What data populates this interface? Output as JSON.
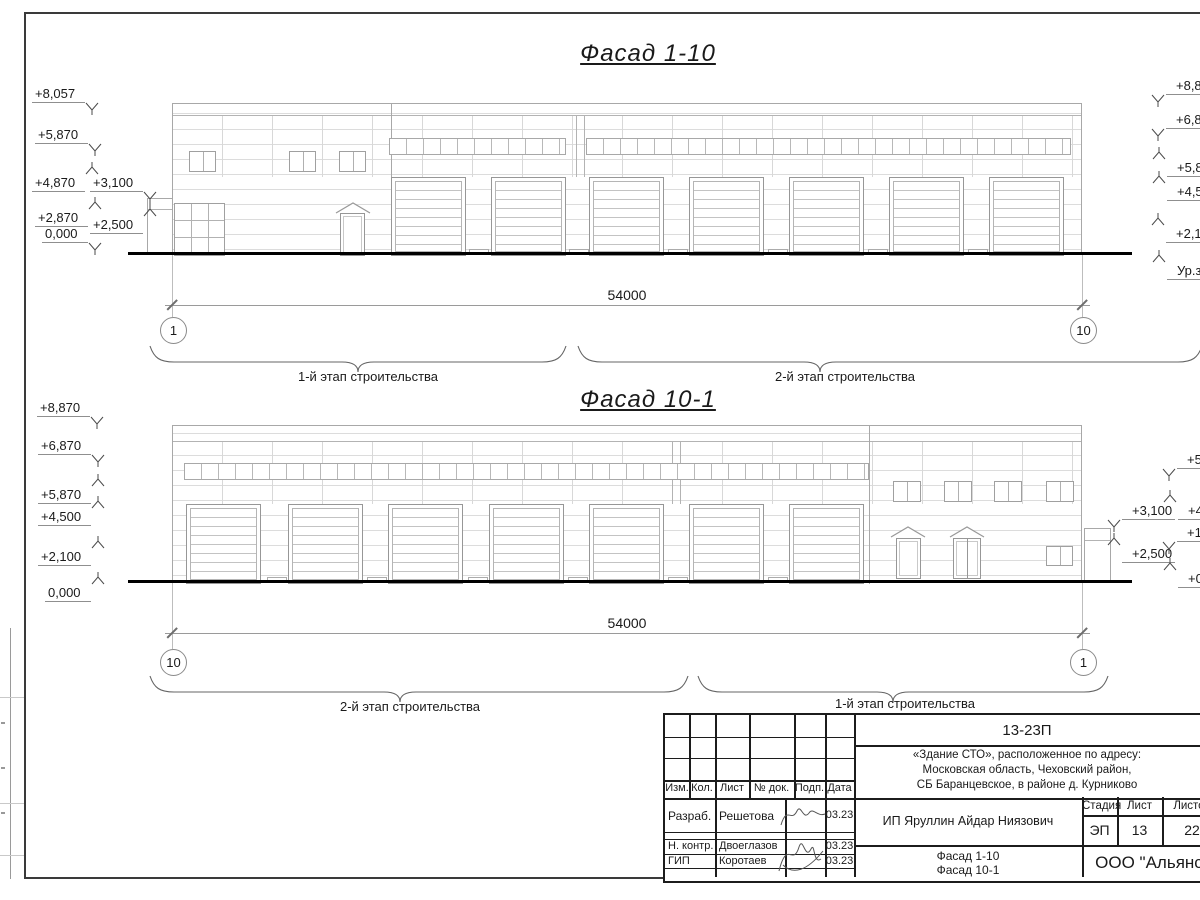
{
  "facade1": {
    "title": "Фасад 1-10",
    "dimension": "54000",
    "axis_left": "1",
    "axis_right": "10",
    "stage_label_left": "1-й этап строительства",
    "stage_label_right": "2-й этап строительства",
    "left_marks": [
      "+8,057",
      "+5,870",
      "+4,870",
      "+3,100",
      "+2,870",
      "+2,500",
      "0,000"
    ],
    "right_marks": [
      "+8,870",
      "+6,870",
      "+5,87",
      "+4,50",
      "+2,10",
      "Ур.зе"
    ]
  },
  "facade2": {
    "title": "Фасад 10-1",
    "dimension": "54000",
    "axis_left": "10",
    "axis_right": "1",
    "stage_label_left": "2-й этап строительства",
    "stage_label_right": "1-й этап строительства",
    "left_marks": [
      "+8,870",
      "+6,870",
      "+5,870",
      "+4,500",
      "+2,100",
      "0,000"
    ],
    "right_marks_inner": [
      "+3,100",
      "+2,500"
    ],
    "right_marks_edge": [
      "+5,8",
      "+4,8",
      "+1,8",
      "+0,8"
    ]
  },
  "title_block": {
    "doc_number": "13-23П",
    "address_lines": [
      "«Здание СТО», расположенное по адресу:",
      "Московская область, Чеховский район,",
      "СБ Баранцевское, в районе д. Курниково"
    ],
    "col_headers": [
      "Изм.",
      "Кол.",
      "Лист",
      "№ док.",
      "Подп.",
      "Дата"
    ],
    "sign_rows": [
      {
        "role": "Разраб.",
        "name": "Решетова",
        "date": "03.23"
      },
      {
        "role": "Н. контр.",
        "name": "Двоеглазов",
        "date": "03.23"
      },
      {
        "role": "ГИП",
        "name": "Коротаев",
        "date": "03.23"
      }
    ],
    "client": "ИП Яруллин Айдар Ниязович",
    "stage_header": "Стадия",
    "sheet_header": "Лист",
    "sheets_header": "Листов",
    "stage": "ЭП",
    "sheet_no": "13",
    "sheets_total": "22",
    "drawing_name_lines": [
      "Фасад 1-10",
      "Фасад 10-1"
    ],
    "company": "ООО \"Альянс\""
  }
}
